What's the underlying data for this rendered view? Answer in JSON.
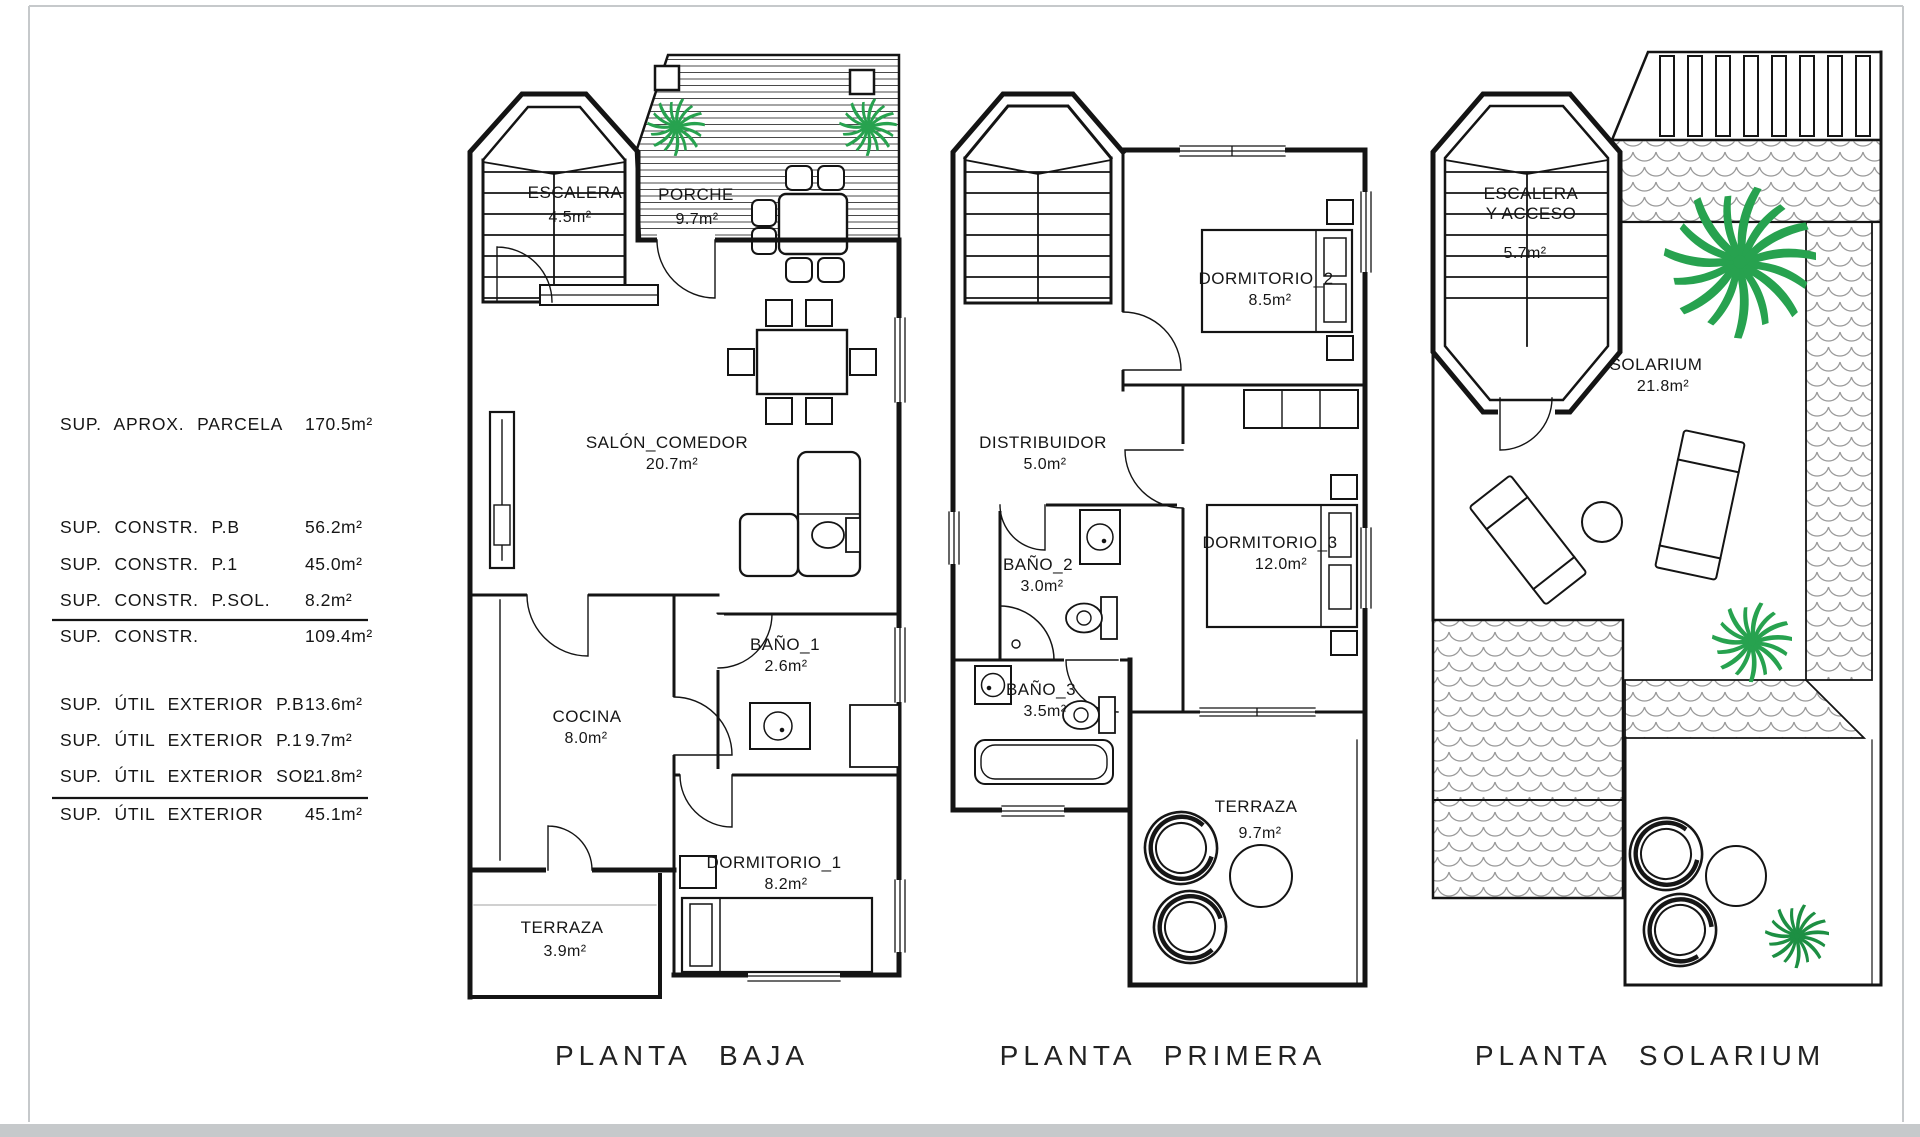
{
  "sheet": {
    "background": "#ffffff",
    "line_color": "#141414",
    "frame_color": "#c6c9cb",
    "plant_green": "#27a24f",
    "shrub_green": "#1d8f43"
  },
  "area_table": {
    "rows": [
      {
        "label": "SUP. APROX. PARCELA",
        "value": "170.5m²"
      },
      {
        "label": "SUP. CONSTR. P.B",
        "value": "56.2m²"
      },
      {
        "label": "SUP. CONSTR. P.1",
        "value": "45.0m²"
      },
      {
        "label": "SUP. CONSTR. P.SOL.",
        "value": "8.2m²"
      },
      {
        "label": "SUP. CONSTR.",
        "value": "109.4m²"
      },
      {
        "label": "SUP. ÚTIL EXTERIOR P.B",
        "value": "13.6m²"
      },
      {
        "label": "SUP. ÚTIL EXTERIOR P.1",
        "value": "9.7m²"
      },
      {
        "label": "SUP. ÚTIL EXTERIOR SOL.",
        "value": "21.8m²"
      },
      {
        "label": "SUP. ÚTIL EXTERIOR",
        "value": "45.1m²"
      }
    ]
  },
  "plans": {
    "baja": {
      "title": "PLANTA BAJA",
      "rooms": {
        "escalera": {
          "name": "ESCALERA",
          "area": "4.5m²"
        },
        "porche": {
          "name": "PORCHE",
          "area": "9.7m²"
        },
        "salon": {
          "name": "SALÓN_COMEDOR",
          "area": "20.7m²"
        },
        "cocina": {
          "name": "COCINA",
          "area": "8.0m²"
        },
        "bano1": {
          "name": "BAÑO_1",
          "area": "2.6m²"
        },
        "dormitorio1": {
          "name": "DORMITORIO_1",
          "area": "8.2m²"
        },
        "terraza": {
          "name": "TERRAZA",
          "area": "3.9m²"
        }
      }
    },
    "primera": {
      "title": "PLANTA PRIMERA",
      "rooms": {
        "dormitorio2": {
          "name": "DORMITORIO_2",
          "area": "8.5m²"
        },
        "distribuidor": {
          "name": "DISTRIBUIDOR",
          "area": "5.0m²"
        },
        "bano2": {
          "name": "BAÑO_2",
          "area": "3.0m²"
        },
        "bano3": {
          "name": "BAÑO_3",
          "area": "3.5m²"
        },
        "dormitorio3": {
          "name": "DORMITORIO_3",
          "area": "12.0m²"
        },
        "terraza": {
          "name": "TERRAZA",
          "area": "9.7m²"
        }
      }
    },
    "solarium": {
      "title": "PLANTA SOLARIUM",
      "rooms": {
        "escalera": {
          "name": "ESCALERA",
          "name_line2": "Y ACCESO",
          "area": "5.7m²"
        },
        "solarium": {
          "name": "SOLARIUM",
          "area": "21.8m²"
        }
      }
    }
  }
}
